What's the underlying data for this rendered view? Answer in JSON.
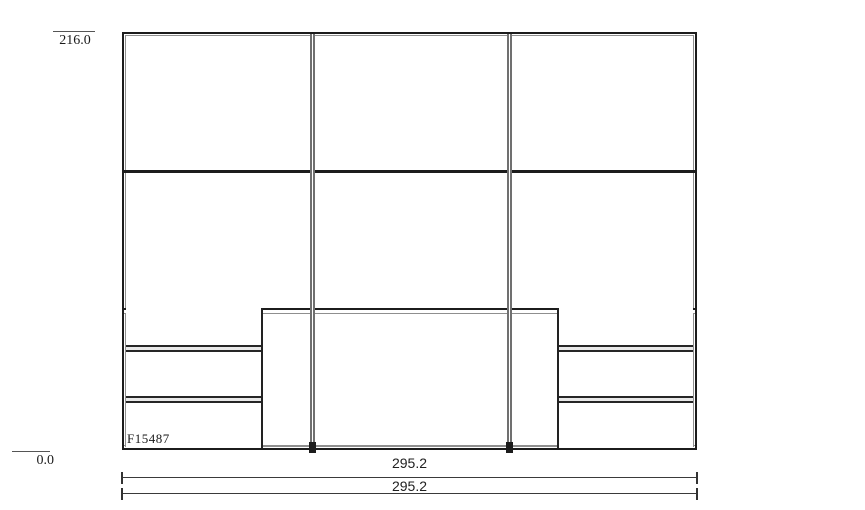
{
  "drawing": {
    "model_code": "F15487",
    "elevation": {
      "top": "216.0",
      "bottom": "0.0"
    },
    "dimensions": {
      "row1": "295.2",
      "row2": "295.2"
    },
    "structure": {
      "type": "wardrobe-front-elevation",
      "columns": 3,
      "upper_door_rows": 2,
      "left_drawer_count": 3,
      "right_drawer_count": 3,
      "center_lower_panel": 1
    }
  },
  "colors": {
    "line_dark": "#1c1c1c",
    "line_med": "#3a3a3a",
    "line_gray": "#8f8f8f",
    "divider_gray": "#707070",
    "sep_fill": "#e8e8e8",
    "bg": "#ffffff",
    "text": "#1a1a1a"
  }
}
